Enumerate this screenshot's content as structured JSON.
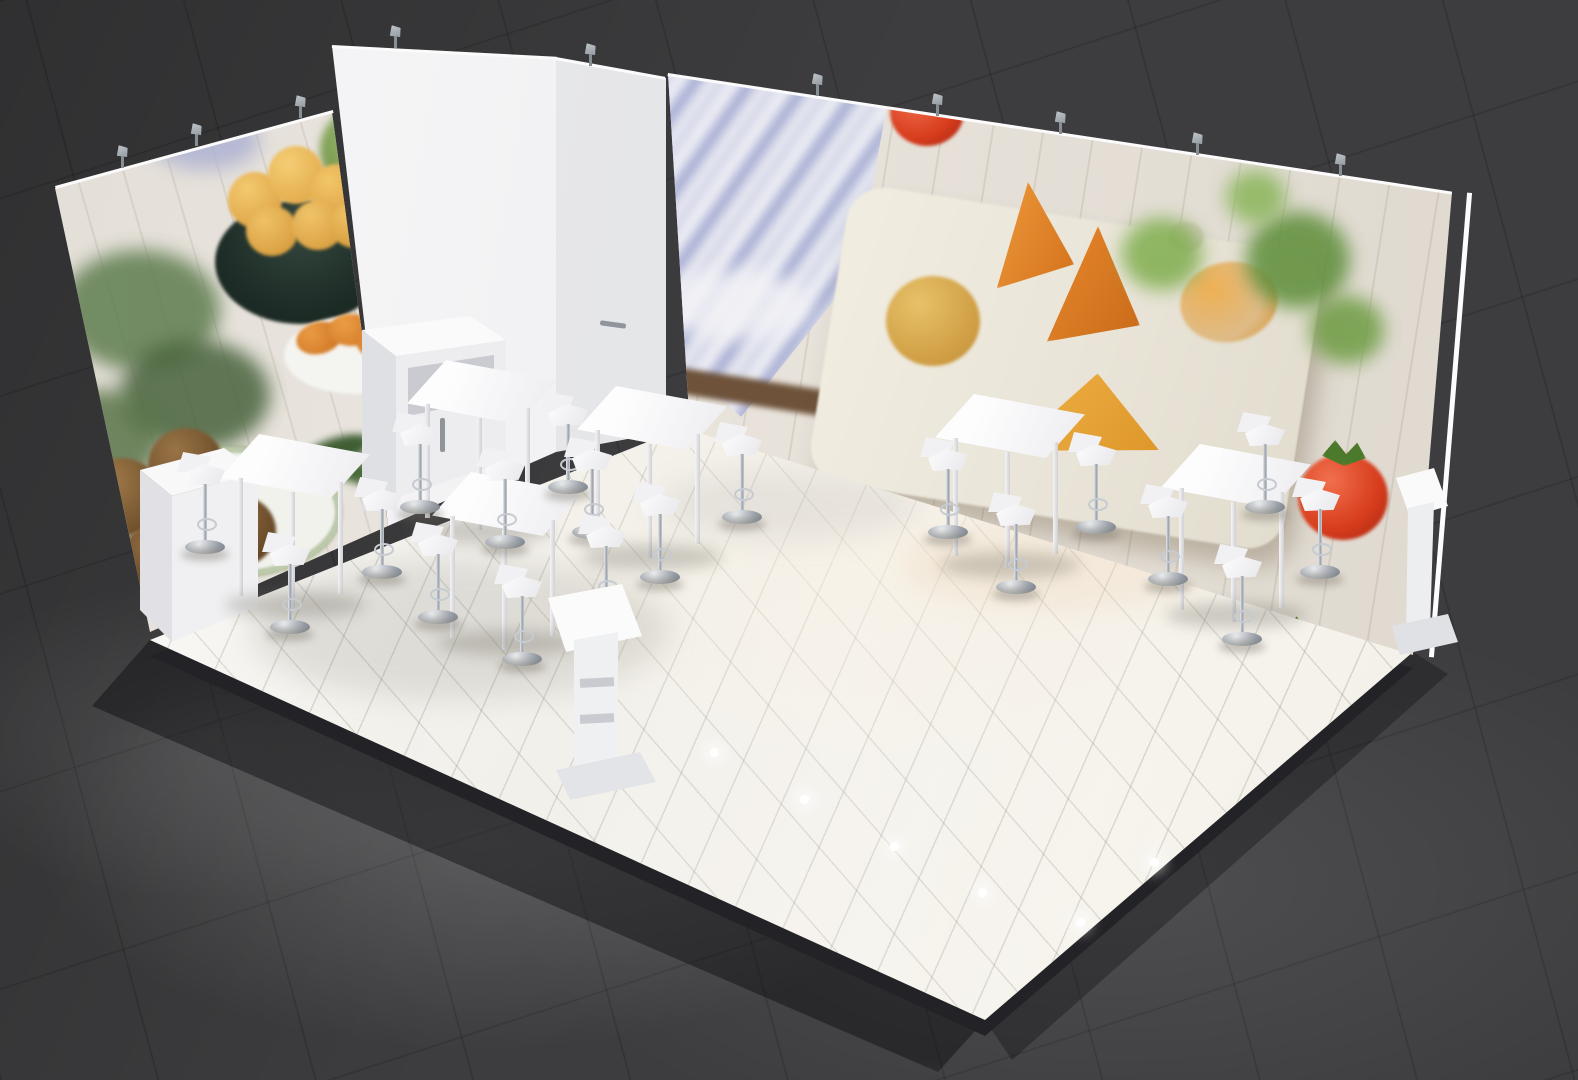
{
  "scene": {
    "type": "3d-render",
    "subject": "trade-show exhibition booth for fried food products",
    "view": "elevated three-quarter perspective",
    "text_visible": false,
    "environment": "dark tiled exhibition-hall floor with soft light pools"
  },
  "palette": {
    "hall_floor": "#3d3d3f",
    "platform": "#f3f1ec",
    "platform_edge": "#232327",
    "wall_white": "#f2f2f4",
    "graphic_base": "#e7e2da",
    "furniture_white": "#f8f8fa",
    "chrome": "#aeb4bb",
    "clamp_gray": "#a3aab0",
    "tomato_red": "#d63c1c",
    "basil_green": "#5c8d38",
    "croquette_orange": "#e08428",
    "croquette_gold": "#d9ad52",
    "falafel_brown": "#7c5a34",
    "bowl_teal": "#22312b",
    "towel_blue": "#7e88c2",
    "board_cream": "#ece7da",
    "handle_gray": "#8f959b",
    "floorlight": "#ffffff"
  },
  "objects": {
    "walls": [
      {
        "id": "left-wall-graphic",
        "photo_content": "rosemary sprigs, dark bowl of golden potato croquettes, breaded falafel balls on patterned plate, orange croquettes on plate, green romanesco, linen cloth"
      },
      {
        "id": "back-wall-graphic",
        "photo_content": "blue-white checkered tea towel, wooden cutting board with arancini and breaded croquette cones, fried triangle, basil leaves, three red tomatoes"
      }
    ],
    "storage_column": {
      "faces": 2,
      "door_handle": true
    },
    "furniture": {
      "bar_tables": 6,
      "bar_stools": 18,
      "counter_cabinet": 1,
      "corner_plinth": 1,
      "brochure_stands": 2
    },
    "lighting": {
      "wall_clamp_spotlights": 10,
      "recessed_floor_spotlights": 6
    }
  }
}
